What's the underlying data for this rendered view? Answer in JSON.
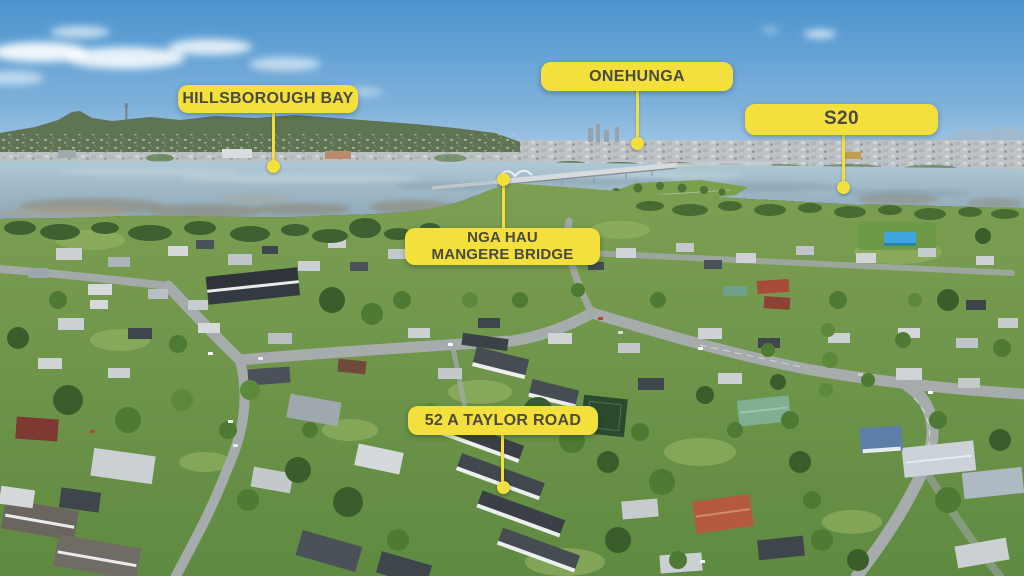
{
  "colors": {
    "label_background": "#F4E03C",
    "label_text": "#4A4A3F",
    "leader_line": "#F4E03C"
  },
  "labels": [
    {
      "id": "hillsborough-bay",
      "text": "HILLSBOROUGH BAY"
    },
    {
      "id": "onehunga",
      "text": "ONEHUNGA"
    },
    {
      "id": "s20",
      "text": "S20"
    },
    {
      "id": "nga-hau-mangere-bridge",
      "line1": "NGA HAU",
      "line2": "MANGERE BRIDGE"
    },
    {
      "id": "taylor-road",
      "text": "52 A TAYLOR ROAD"
    }
  ]
}
